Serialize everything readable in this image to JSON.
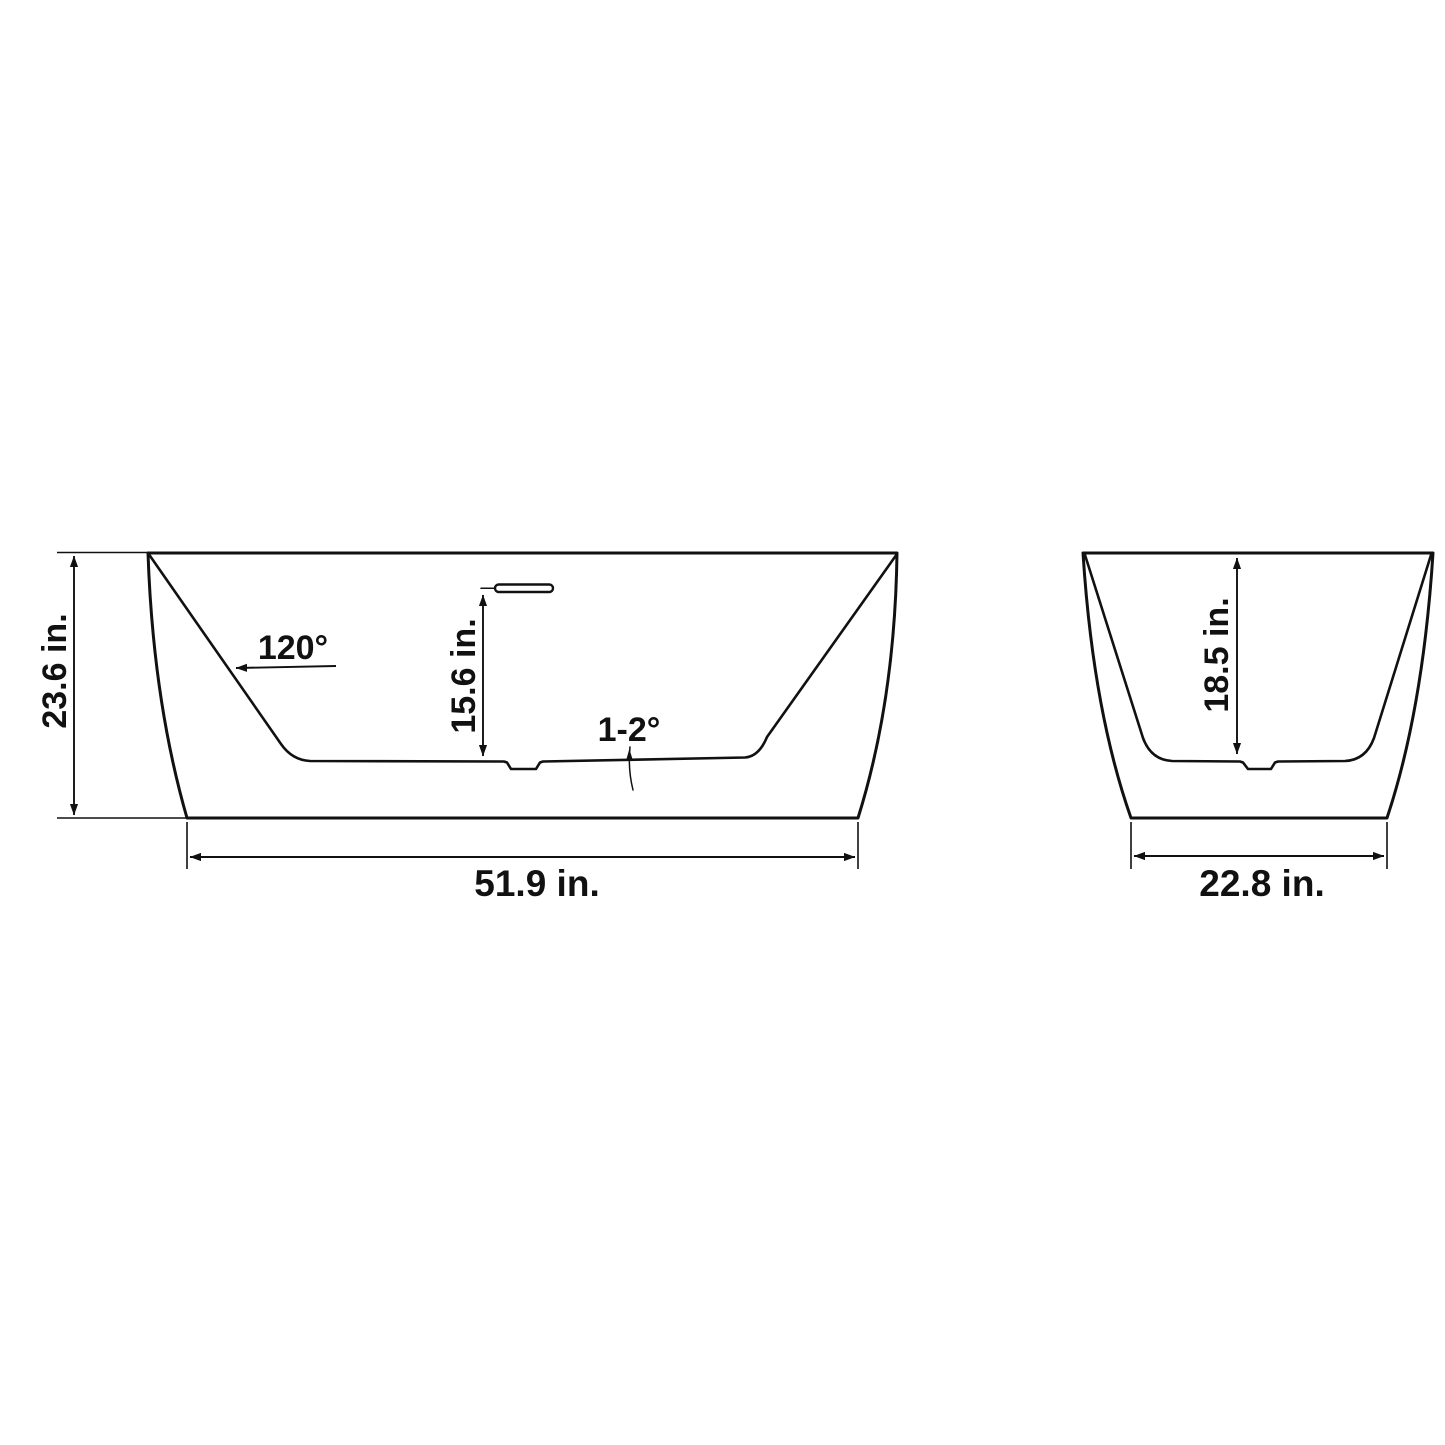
{
  "colors": {
    "background": "#ffffff",
    "line": "#111111"
  },
  "drawing": {
    "side_view": {
      "height_label": "23.6 in.",
      "rim_angle_label": "120°",
      "interior_depth_label": "15.6 in.",
      "floor_slope_label": "1-2°",
      "length_label": "51.9 in."
    },
    "end_view": {
      "interior_depth_label": "18.5 in.",
      "width_label": "22.8 in."
    }
  }
}
